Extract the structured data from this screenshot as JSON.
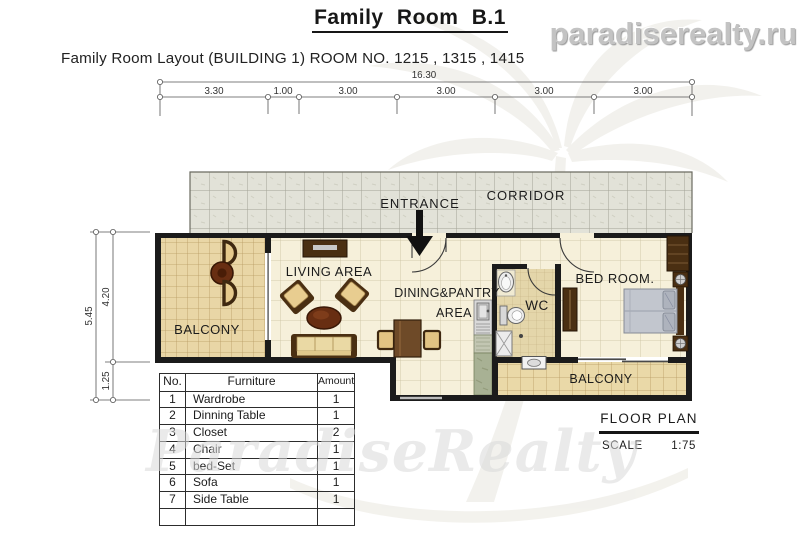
{
  "header": {
    "title": "Family Room B.1",
    "website": "paradiserealty.ru",
    "subtitle": "Family Room Layout (BUILDING 1) ROOM NO. 1215 , 1315 , 1415"
  },
  "dimensions": {
    "top_total": "16.30",
    "top_segments": [
      "3.30",
      "1.00",
      "3.00",
      "3.00",
      "3.00",
      "3.00"
    ],
    "left_total": "5.45",
    "left_upper": "4.20",
    "left_lower": "1.25"
  },
  "rooms": {
    "corridor": "CORRIDOR",
    "entrance": "ENTRANCE",
    "living_area": "LIVING AREA",
    "dining_line1": "DINING&PANTRY",
    "dining_line2": "AREA",
    "wc": "WC",
    "bedroom": "BED ROOM.",
    "balcony_left": "BALCONY",
    "balcony_right": "BALCONY"
  },
  "furniture_table": {
    "headers": [
      "No.",
      "Furniture",
      "Amount"
    ],
    "rows": [
      [
        "1",
        "Wardrobe",
        "1"
      ],
      [
        "2",
        "Dinning Table",
        "1"
      ],
      [
        "3",
        "Closet",
        "2"
      ],
      [
        "4",
        "Chair",
        "1"
      ],
      [
        "5",
        "bed-Set",
        "1"
      ],
      [
        "6",
        "Sofa",
        "1"
      ],
      [
        "7",
        "Side Table",
        "1"
      ],
      [
        "",
        "",
        ""
      ]
    ]
  },
  "title_block": {
    "name": "FLOOR PLAN",
    "scale_label": "SCALE",
    "scale_value": "1:75"
  },
  "watermark": {
    "text": "ParadiseRealty"
  },
  "colors": {
    "wall": "#1b1b1b",
    "floor_tile": "#f6f0da",
    "corridor_tile": "#e2e2d8",
    "balcony_tile": "#e9d6a6",
    "wc_tile": "#e4d6aa",
    "wood_dark": "#4a2f12",
    "wood_mid": "#6e4a28",
    "cushion_tan": "#e6c98c",
    "mattress_gray": "#c2c6ce",
    "counter_green": "#a8b194",
    "watermark_gray": "#dadada"
  }
}
